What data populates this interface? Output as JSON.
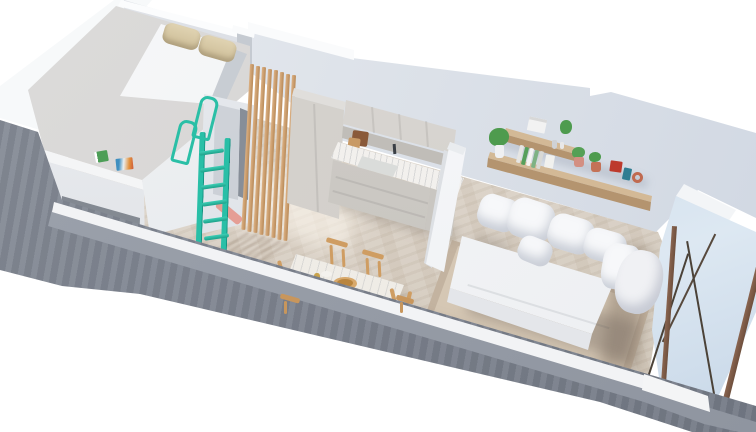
{
  "meta": {
    "title": "3D axonometric cutaway render of a studio apartment floor plan",
    "type": "architectural-render",
    "view": "isometric top-down cutaway",
    "background": "#ffffff",
    "visible_text": "none"
  },
  "palette": {
    "background": "#ffffff",
    "white_wall": "#f7f9fa",
    "back_wall_face": "#dde2e9",
    "concrete_top": "#99a0ab",
    "concrete_face": "#7f8591",
    "floor_beige": "#dbd2c5",
    "loft_floor_gray": "#d7d5d4",
    "mattress_white": "#f5f6f7",
    "pillow_beige": "#d9cba7",
    "ladder_teal": "#2abfa6",
    "slat_wood": "#d4a878",
    "shelf_wood": "#c9ae8e",
    "chair_wood": "#cf9d62",
    "cabinet_greige": "#d4d1cc",
    "counter_marble": "#f2f0ed",
    "sofa_white": "#f4f5f7",
    "rug_beige": "#d5c7b4",
    "window_glass": "#d5e2ee",
    "window_frame": "#7d5b45",
    "plant_green": "#4e9b4e",
    "decor_red": "#bd3a2d",
    "decor_terracotta": "#c47257",
    "decor_pink": "#d38f82",
    "decor_teal": "#2f7d92",
    "accent_salmon": "#e59a90"
  },
  "rooms": [
    {
      "name": "sleeping-loft",
      "furniture": [
        "raised platform floor",
        "double mattress",
        "two beige pillows",
        "teal access ladder with grab rails",
        "storage niche under platform",
        "two books on platform edge",
        "interior door"
      ]
    },
    {
      "name": "entry-passage",
      "furniture": [
        "wooden slat screen with 8 vertical slats"
      ]
    },
    {
      "name": "kitchen",
      "furniture": [
        "tall cabinet column",
        "upper cabinet row",
        "marble countertop",
        "sink with faucet",
        "cutting boards",
        "drawer base units",
        "white divider panel"
      ]
    },
    {
      "name": "living-area",
      "furniture": [
        "white sofa bed",
        "six white cushions",
        "beige area rug",
        "two wooden wall shelves",
        "potted plants",
        "book stack",
        "red box",
        "teal book",
        "terracotta decor"
      ]
    },
    {
      "name": "dining-area",
      "furniture": [
        "marble top table with wooden trestle legs",
        "four wooden chairs",
        "wooden bowl",
        "plate",
        "brass cup"
      ]
    },
    {
      "name": "envelope",
      "furniture": [
        "white back walls with stepped top edge",
        "gray concrete cutaway front wall",
        "floor-to-ceiling window with bronze frame and diagonal braces"
      ]
    }
  ]
}
